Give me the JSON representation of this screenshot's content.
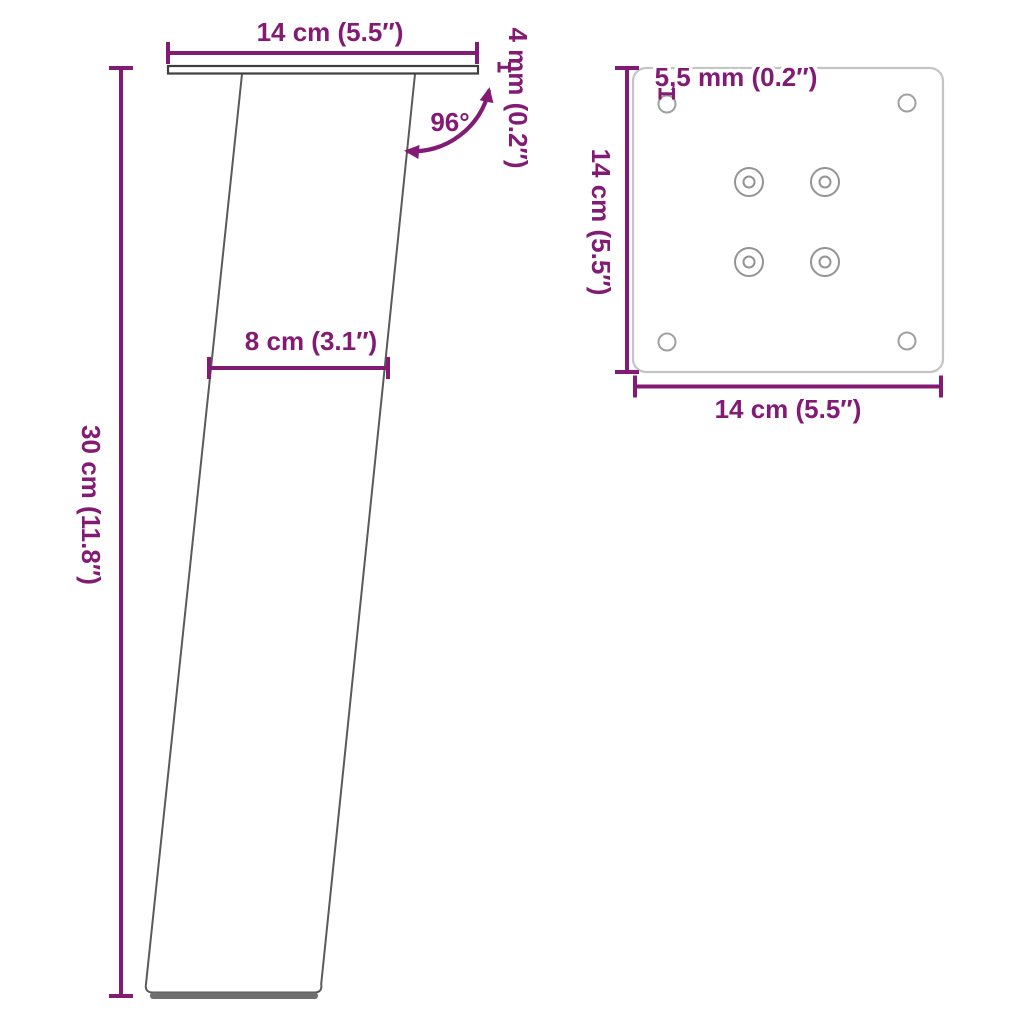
{
  "colors": {
    "accent": "#831A74",
    "side_outline": "#3E3E3E",
    "leg_edge": "#5A5A5A",
    "foot": "#6F6F6F",
    "plate_outline": "#C4C4C4",
    "hole_outline": "#A0A0A0"
  },
  "side_view": {
    "top_width_label": "14 cm (5.5″)",
    "thickness_label": "4 mm (0.2″)",
    "angle_label": "96°",
    "mid_width_label": "8 cm (3.1″)",
    "height_label": "30 cm (11.8″)"
  },
  "top_view": {
    "hole_diameter_label": "5,5 mm (0.2″)",
    "side_length_label": "14 cm (5.5″)",
    "bottom_length_label": "14 cm (5.5″)"
  }
}
